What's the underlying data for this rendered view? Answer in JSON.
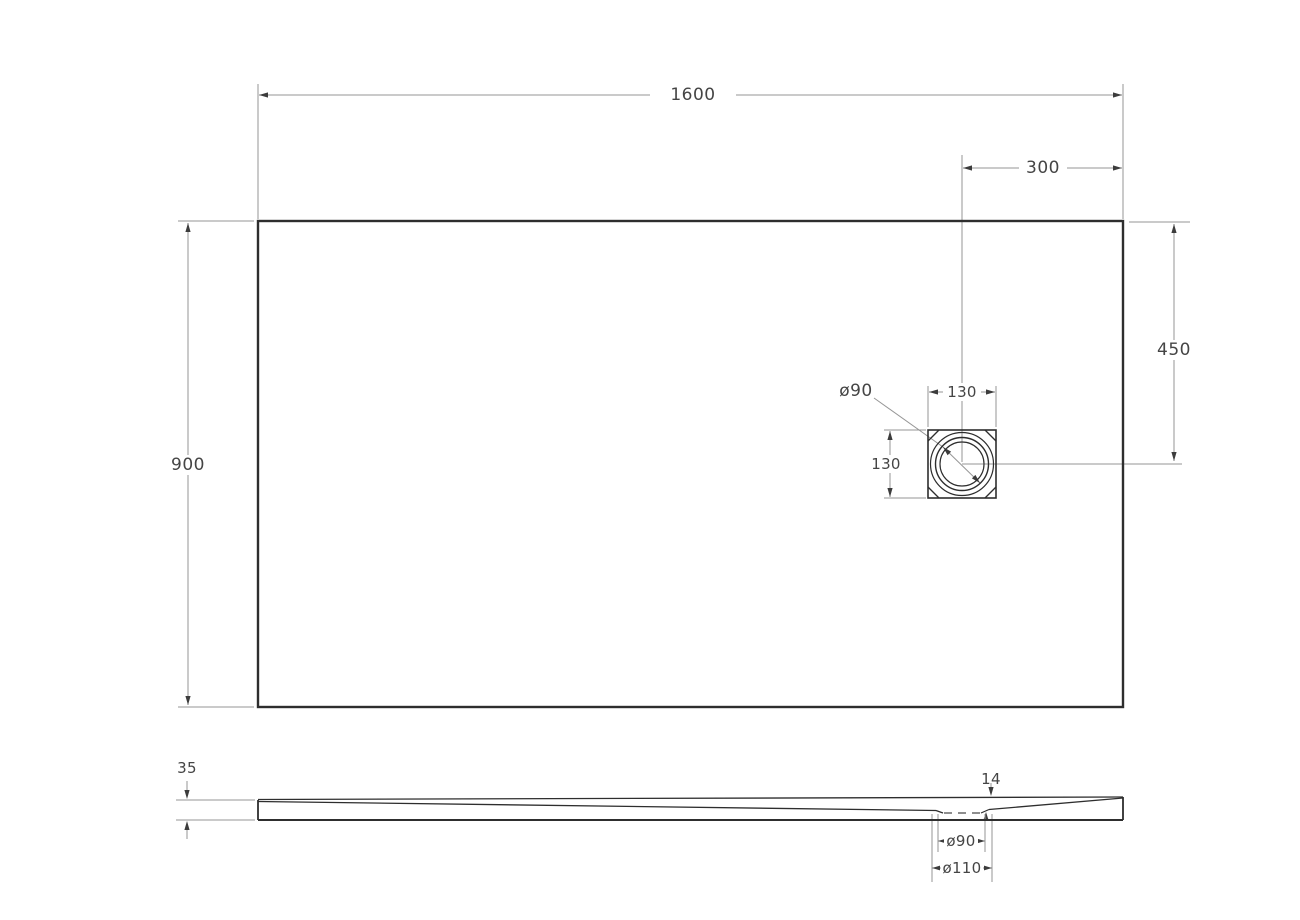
{
  "dimensions": {
    "top_view": {
      "overall_width": "1600",
      "overall_depth": "900",
      "drain_center_from_right_edge": "300",
      "drain_center_from_top_edge": "450",
      "drain_cutout_width": "130",
      "drain_cutout_height": "130",
      "drain_cover_diameter": "ø90"
    },
    "section_view": {
      "tray_thickness": "35",
      "drain_recess_depth": "14",
      "drain_hole_diameter": "ø90",
      "drain_flange_diameter": "ø110"
    }
  },
  "colors": {
    "background": "#ffffff",
    "object_line": "#2e2e2e",
    "dimension_line": "#969696",
    "text": "#454545"
  }
}
